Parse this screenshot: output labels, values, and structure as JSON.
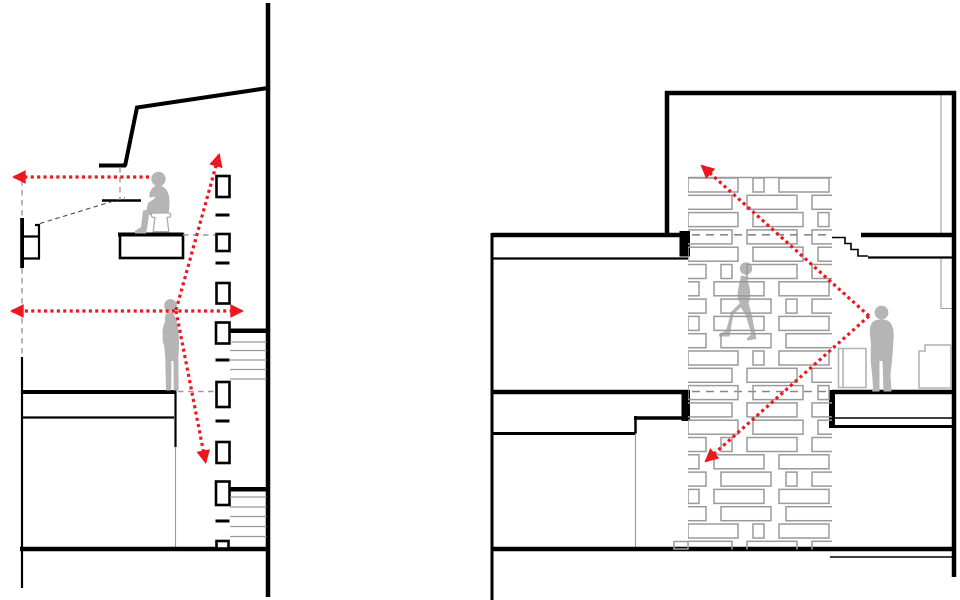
{
  "page": {
    "title": "Architectural section diagrams with red sight-line arrows",
    "background": "#ffffff",
    "panel_count": 2
  },
  "palette": {
    "ink": "#000000",
    "arrow_red": "#ee1720",
    "figure_gray": "#b5b5b5",
    "brick_outline": "#9a9a9a",
    "dashed_gray": "#9a9a9a",
    "furniture_outline": "#b2b2b2",
    "stair_gray": "#9b9b9b"
  },
  "panels": [
    {
      "id": "left-section",
      "label": "Split-level section with window mullion column",
      "figures": [
        {
          "name": "seated-figure",
          "posture": "seated on stool at mezzanine desk, facing left"
        },
        {
          "name": "standing-figure",
          "posture": "standing on mid floor, facing left"
        }
      ],
      "sight_lines": [
        {
          "name": "seated-horizontal-arrow",
          "direction": "left"
        },
        {
          "name": "standing-horizontal-arrow",
          "direction": "double-headed left and right"
        },
        {
          "name": "standing-up-arrow",
          "direction": "up through window column"
        },
        {
          "name": "standing-down-arrow",
          "direction": "down through window column"
        }
      ],
      "window_sections": 8,
      "stair_flights": 2
    },
    {
      "id": "right-section",
      "label": "Section through perforated hit-and-miss brick screen",
      "figures": [
        {
          "name": "walking-figure",
          "posture": "climbing stair behind brick screen"
        },
        {
          "name": "standing-figure",
          "posture": "standing at floor edge, facing the screen"
        }
      ],
      "sight_lines": [
        {
          "name": "up-through-screen-arrow",
          "direction": "up-left through screen"
        },
        {
          "name": "down-through-screen-arrow",
          "direction": "down-left through screen"
        }
      ],
      "floors": 3
    }
  ],
  "brick_wall": {
    "x": 688,
    "y": 178,
    "width": 144,
    "height": 371,
    "row_pitch": 17.3,
    "brick_h": 14,
    "brick_w": 50,
    "small_w": 11,
    "gap": 15,
    "stagger": 32,
    "rows": 22
  }
}
